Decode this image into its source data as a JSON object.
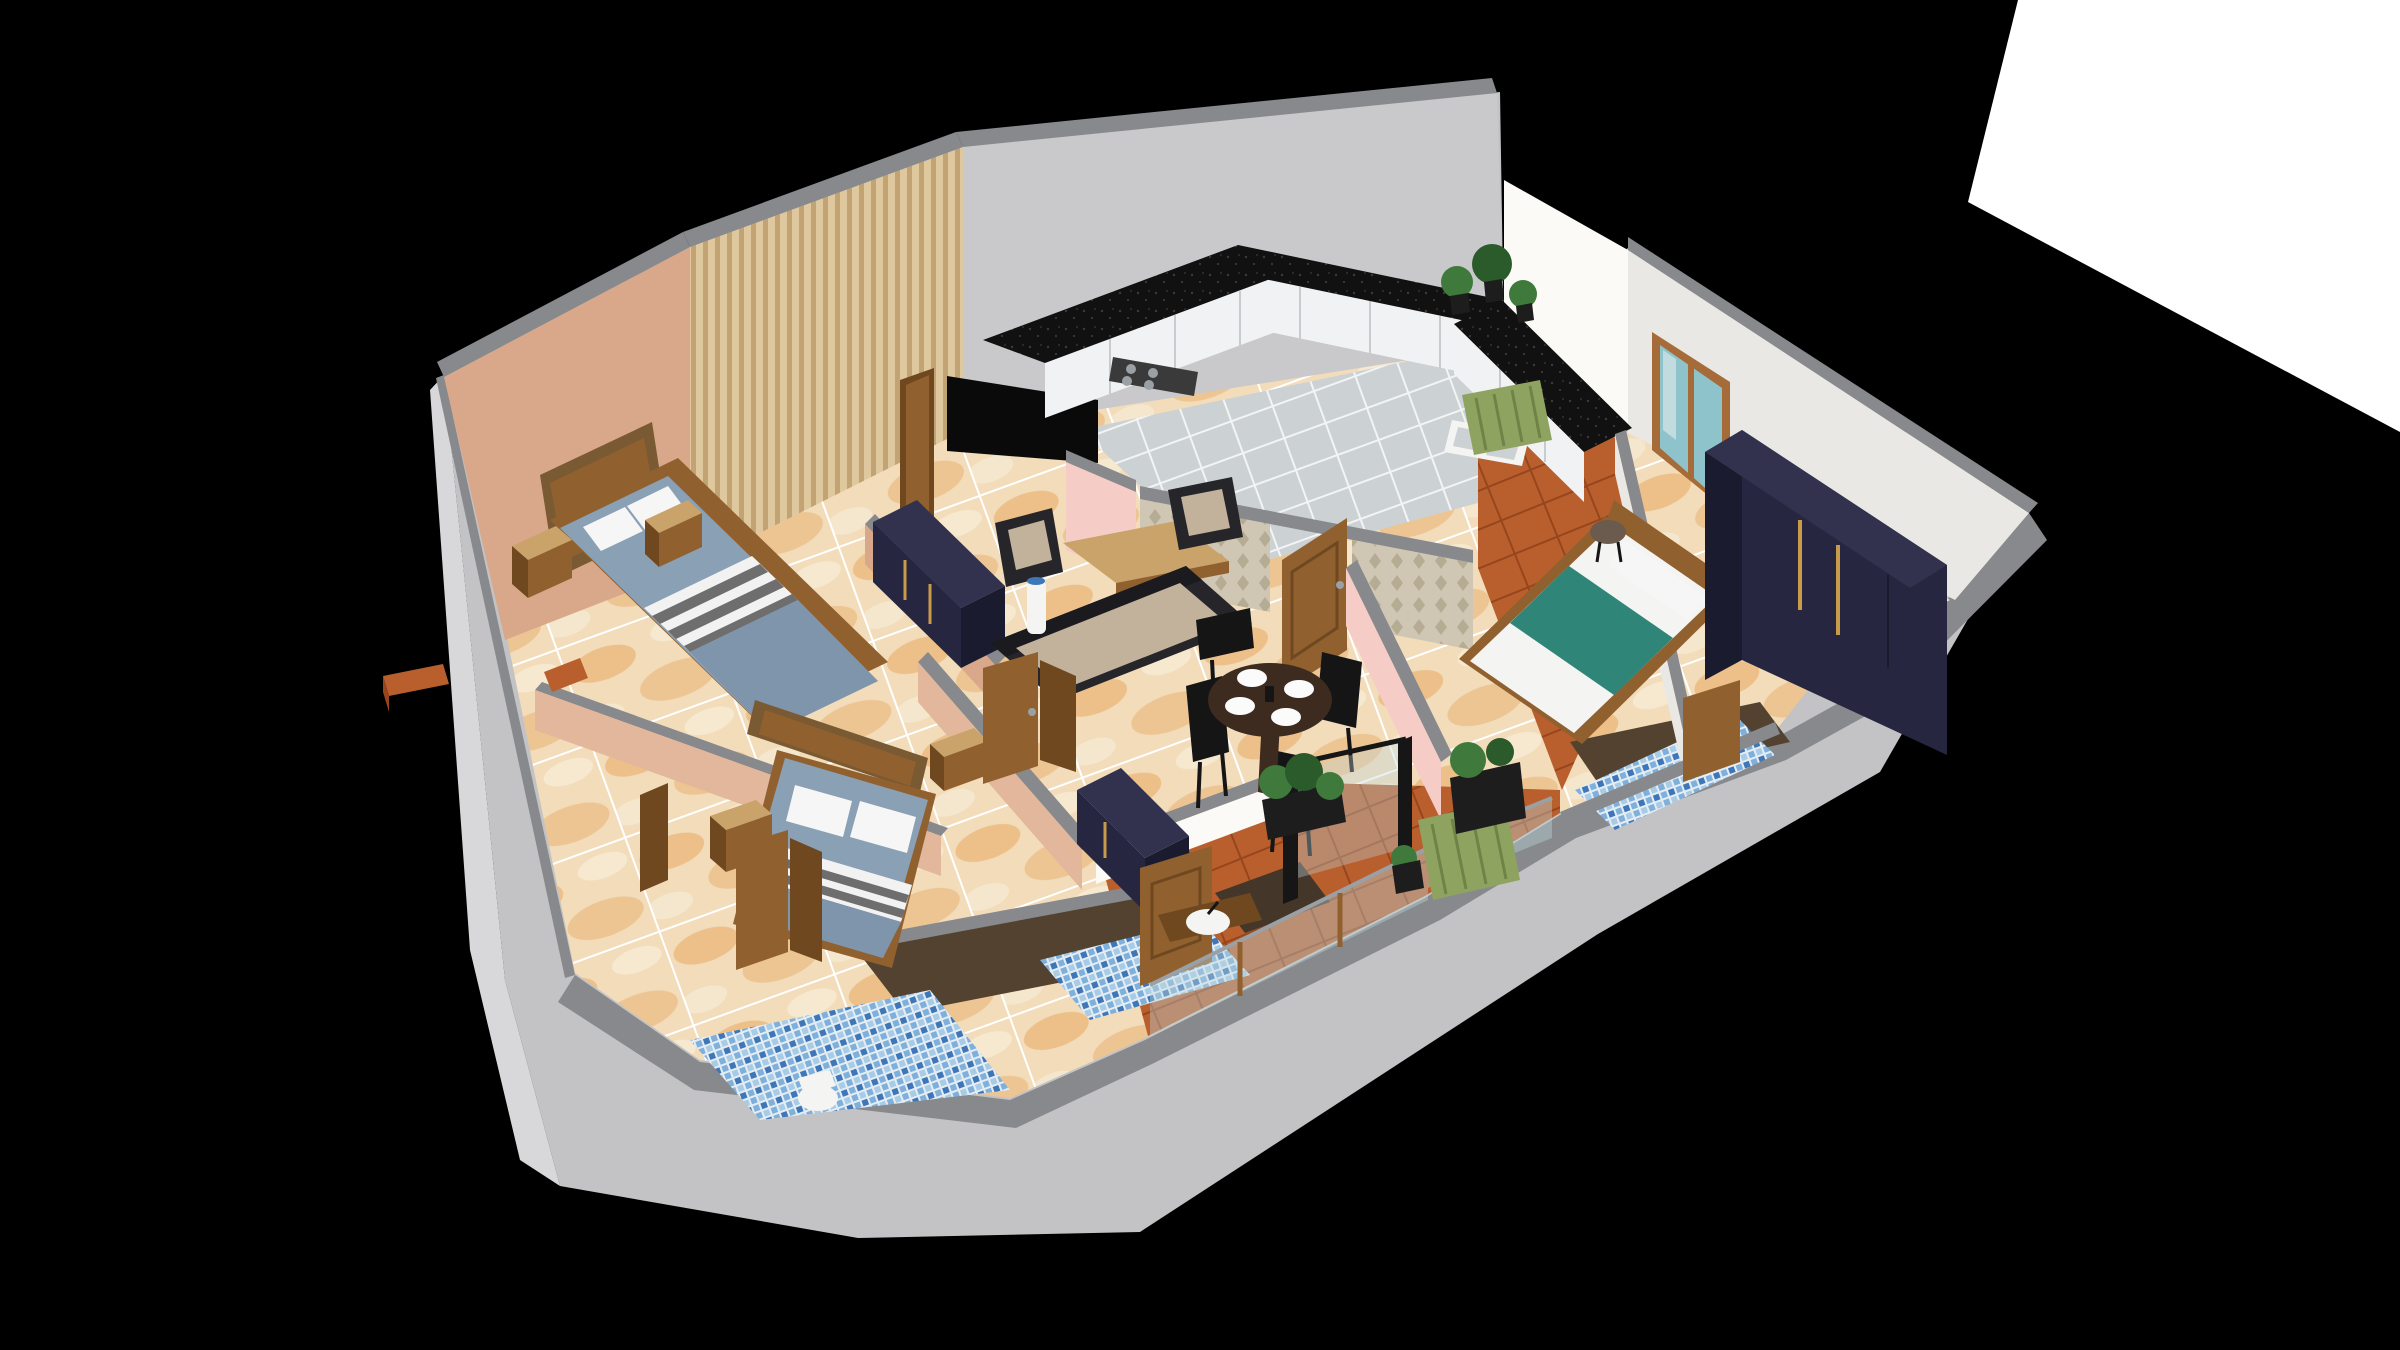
{
  "scene": {
    "type": "3d-floorplan-render",
    "style": "isometric cutaway apartment",
    "background": "#000000",
    "rooms": [
      {
        "name": "bedroom-1",
        "furniture": [
          "double-bed",
          "wood-headboard",
          "nightstand",
          "nightstand",
          "navy-wardrobe"
        ]
      },
      {
        "name": "bedroom-2",
        "furniture": [
          "double-bed",
          "wood-headboard",
          "nightstand",
          "nightstand",
          "navy-wardrobe"
        ]
      },
      {
        "name": "master-bedroom",
        "furniture": [
          "double-bed-teal",
          "wood-headboard",
          "navy-wardrobe",
          "round-stool",
          "window"
        ]
      },
      {
        "name": "living-room",
        "furniture": [
          "tv",
          "wood-slat-wall",
          "sofa",
          "armchair",
          "armchair",
          "coffee-table",
          "floor-vase"
        ]
      },
      {
        "name": "dining-area",
        "furniture": [
          "round-table",
          "dining-chair",
          "dining-chair",
          "dining-chair",
          "dining-chair",
          "plates"
        ]
      },
      {
        "name": "kitchen",
        "furniture": [
          "u-shaped-counter",
          "gas-stove",
          "double-sink",
          "white-cabinets",
          "plants",
          "damask-wall"
        ]
      },
      {
        "name": "bathroom-1",
        "furniture": [
          "toilet",
          "shower-area",
          "blue-mosaic-floor",
          "door"
        ]
      },
      {
        "name": "bathroom-2",
        "furniture": [
          "wash-basin",
          "shower-area",
          "blue-mosaic-floor",
          "door"
        ]
      },
      {
        "name": "master-bathroom",
        "furniture": [
          "shower-area",
          "blue-mosaic-floor",
          "door"
        ]
      },
      {
        "name": "balcony-south",
        "furniture": [
          "lounge-chair",
          "planters",
          "glass-railing",
          "terracotta-floor"
        ]
      },
      {
        "name": "balcony-east",
        "furniture": [
          "lounge-chair",
          "plants",
          "terracotta-floor"
        ]
      }
    ]
  },
  "palette": {
    "bg": "#000000",
    "white_plane": "#ffffff",
    "outer_face": "#c3c3c5",
    "outer_face_light": "#d8d8da",
    "band": "#87898c",
    "tan_wall": "#d9a88a",
    "peach_wall": "#e2b79c",
    "slat_light": "#e0c89e",
    "slat_dark": "#c2a374",
    "gray_wall": "#c9c9cb",
    "white_wall": "#eae8e4",
    "sunlit_wall": "#fbfaf6",
    "pink_wall": "#f5cdc6",
    "damask_base": "#cfc6b4",
    "damask_motif": "#b0a58c",
    "marble_base": "#f2dcba",
    "marble_vein": "#e8a963",
    "marble_vein2": "#f7ecd6",
    "grout": "#ffffff",
    "ktile": "#ccd1d4",
    "ktile_line": "#f2f4f5",
    "terracotta": "#b95f2e",
    "terracotta_line": "#97451c",
    "mosaic_a": "#3e76b8",
    "mosaic_b": "#7fb0dc",
    "mosaic_c": "#a8cbe6",
    "mosaic_d": "#e4edf3",
    "shower_brown": "#53422f",
    "shower_dark": "#45362a",
    "granite": "#111111",
    "granite_speck": "#3a3a3a",
    "cabinet_white": "#f1f2f3",
    "cabinet_line": "#c9cccf",
    "wood": "#91602f",
    "wood_dark": "#6f4820",
    "wood_light": "#c9a36a",
    "frame_wood": "#7a5a33",
    "navy": "#262640",
    "navy_dark": "#1b1b30",
    "navy_top": "#32324e",
    "gold": "#c89b4a",
    "sofa_dark": "#26262a",
    "sofa_darker": "#1b1b1f",
    "cushion": "#c3b29b",
    "mattress": "#8aa0b5",
    "duvet": "#7e95ac",
    "stripe_white": "#f2f2f2",
    "stripe_dark": "#6e6e6e",
    "pillow": "#f6f6f6",
    "teal": "#2f8678",
    "table_brown": "#3c2b1e",
    "chair_black": "#151515",
    "plate": "#fbfbfb",
    "green_chair": "#8fa361",
    "green_chair_line": "#6f8347",
    "plant": "#3f7a3c",
    "plant_dark": "#2b5a2b",
    "planter": "#1d1d1d",
    "glass": "#bcd8dd",
    "glass_frame": "#161616",
    "window_frame": "#a56b39",
    "window_glass": "#8fc3cc",
    "tv": "#0a0a0a",
    "metal": "#9aa0a4",
    "stool": "#6b5a4e",
    "porcelain": "#f4f4f2",
    "shadow": "#000000"
  }
}
